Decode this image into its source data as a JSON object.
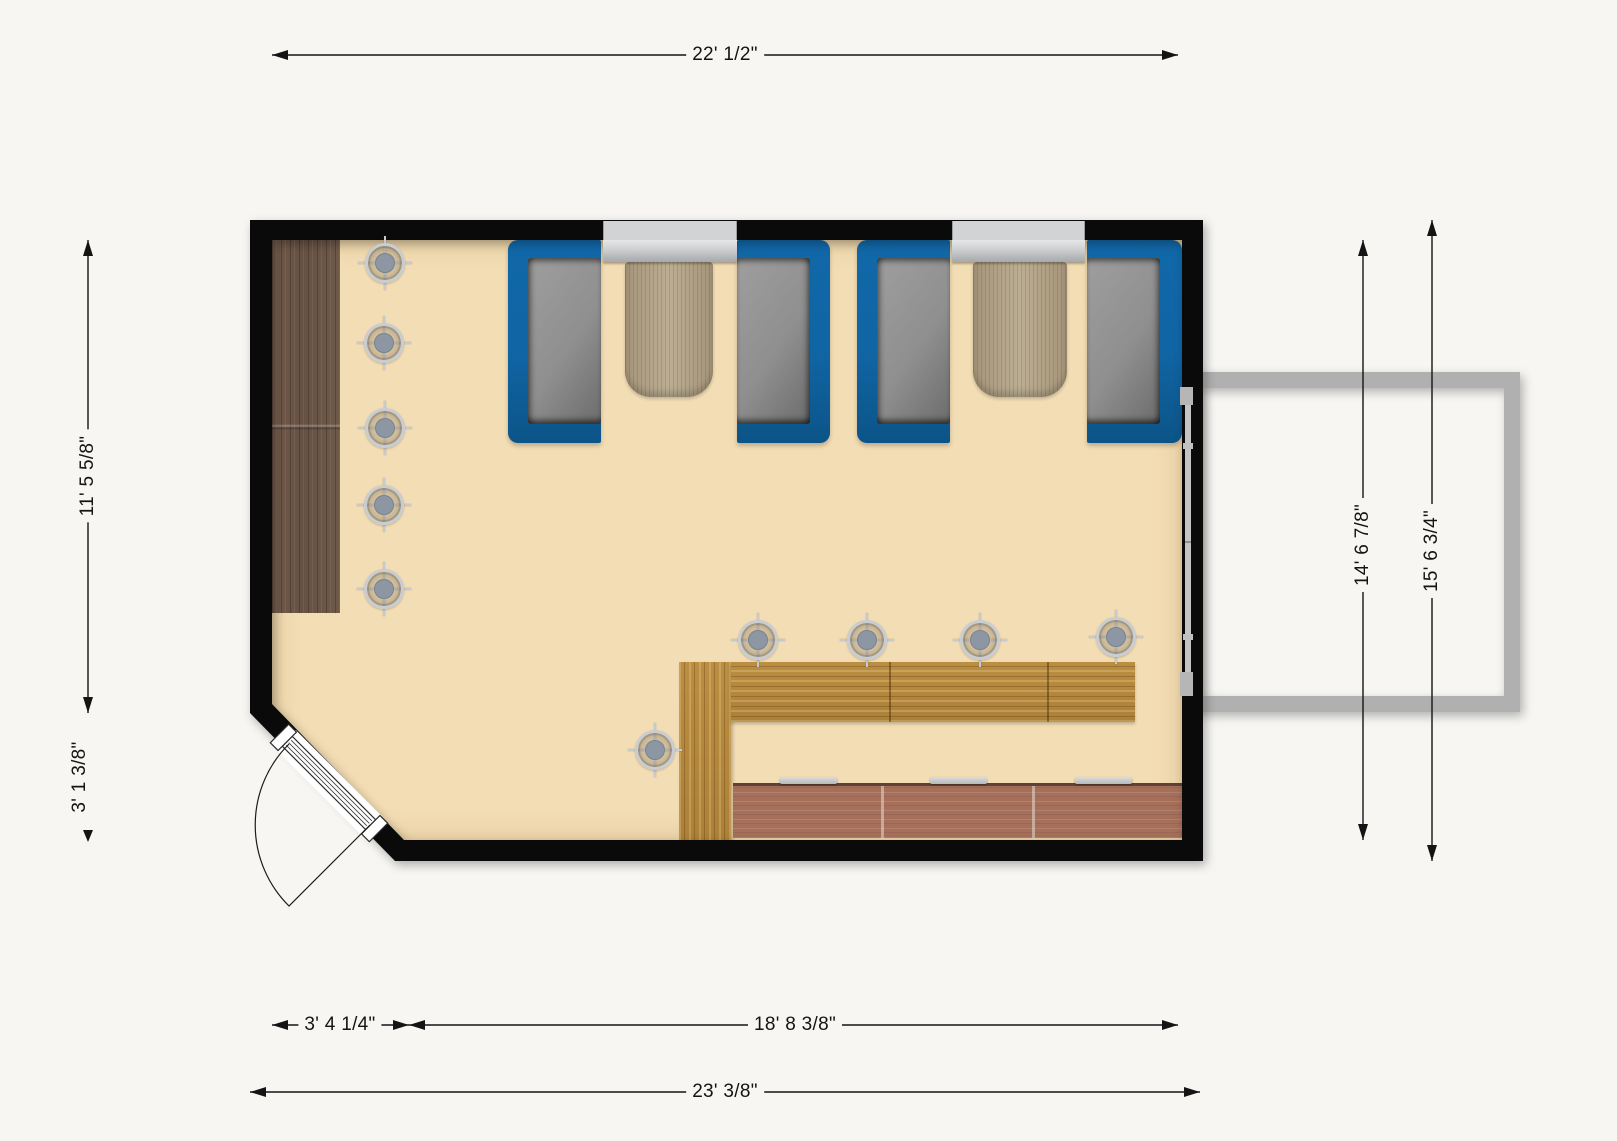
{
  "page": {
    "background": "#f7f6f3",
    "view": "2D floor plan, top view"
  },
  "floor_plan": {
    "room": "dining area with booth seating, service counter and corner entry door",
    "dimensions": {
      "top_width": "22' 1/2\"",
      "left_height_upper": "11' 5 5/8\"",
      "left_height_lower": "3' 1 3/8\"",
      "right_height_interior": "14' 6 7/8\"",
      "right_height_exterior": "15' 6 3/4\"",
      "bottom_width_left": "3' 4 1/4\"",
      "bottom_width_right": "18' 8 3/8\"",
      "bottom_width_total": "23' 3/8\""
    },
    "fixtures": [
      "wood-floor-strip",
      "booth-bench x4",
      "booth-table x2",
      "window x2",
      "service-counter-L",
      "tile-walkway",
      "counter-stool x3",
      "entry-door-with-swing",
      "sliding-door-right-wall",
      "exterior-structure",
      "ceiling-light x10"
    ],
    "lights": [
      [
        385,
        263
      ],
      [
        384,
        343
      ],
      [
        385,
        428
      ],
      [
        384,
        505
      ],
      [
        384,
        589
      ],
      [
        655,
        750
      ],
      [
        758,
        640
      ],
      [
        867,
        640
      ],
      [
        980,
        640
      ],
      [
        1116,
        637
      ]
    ],
    "colors": {
      "wall": "#0a0a0a",
      "floor": "#f3ddb4",
      "booth_blue": "#1065a4",
      "cushion_gray": "#8f8f8f",
      "table_wood": "#b2a287",
      "counter_wood": "#b5883c",
      "tile_floor": "#a66f5a",
      "wood_floor": "#6d5747",
      "exterior_structure": "#b0b0b0",
      "dimension_text": "#141414"
    }
  }
}
